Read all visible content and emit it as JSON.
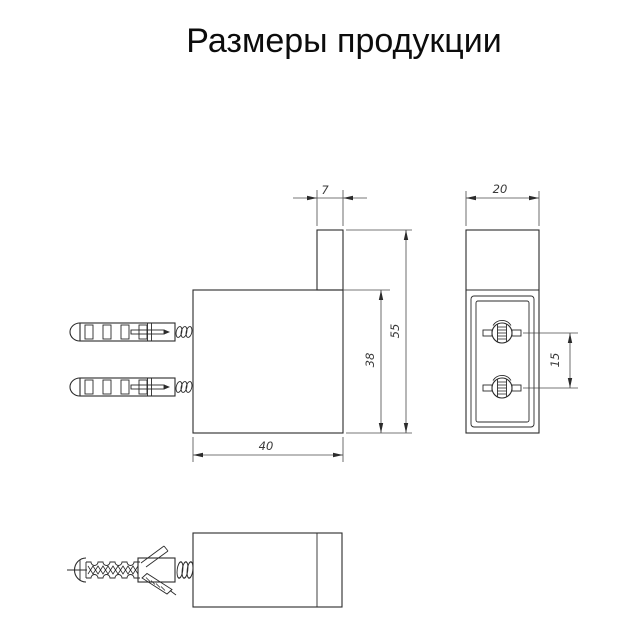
{
  "title": "Размеры продукции",
  "dimensions": {
    "hook_width": "7",
    "total_height": "55",
    "body_height": "38",
    "body_width": "40",
    "depth": "20",
    "screw_spacing": "15"
  },
  "colors": {
    "background": "#ffffff",
    "object_line": "#2b2b2b",
    "dimension_line": "#4a4a4a",
    "text": "#0c0c0c"
  }
}
